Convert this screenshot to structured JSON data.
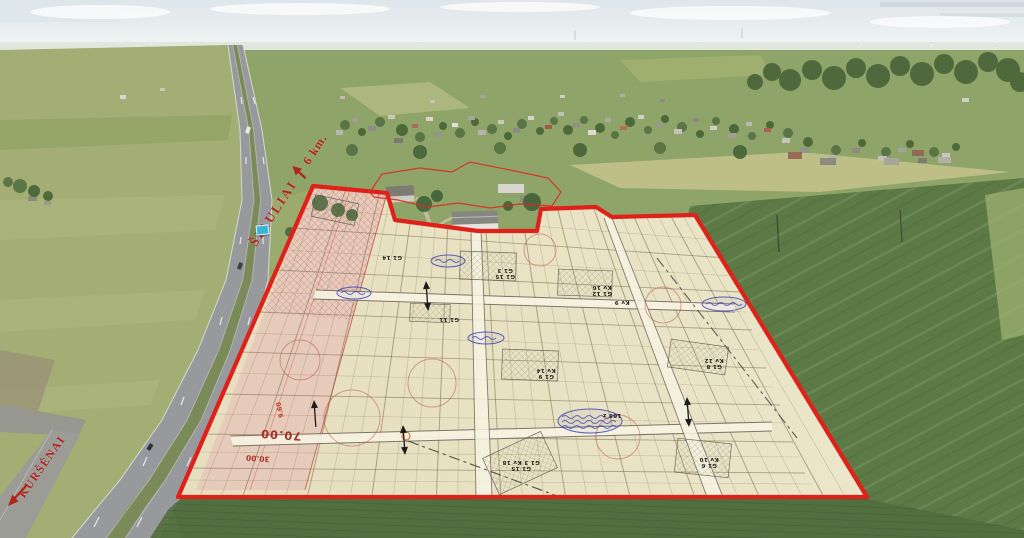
{
  "labels": {
    "siauliai": "ŠIAULIAI",
    "siauliai_distance": "6 km.",
    "kursenai": "KURŠĖNAI"
  },
  "plan": {
    "dims": {
      "d70": "70.00",
      "d30": "30.00",
      "d9": "9.60"
    },
    "plot_labels": [
      {
        "x": 505,
        "y": 272,
        "t": "G1 15\nG1 3"
      },
      {
        "x": 602,
        "y": 289,
        "t": "G1 12\nKv 16"
      },
      {
        "x": 546,
        "y": 372,
        "t": "G1 9\nKv 14"
      },
      {
        "x": 714,
        "y": 362,
        "t": "G1 8\nKv 12"
      },
      {
        "x": 521,
        "y": 464,
        "t": "G1 15\nG1 3 Kv 18"
      },
      {
        "x": 709,
        "y": 461,
        "t": "G1 6\nKv 10"
      },
      {
        "x": 449,
        "y": 318,
        "t": "G1 11"
      },
      {
        "x": 622,
        "y": 301,
        "t": "Kv 9"
      },
      {
        "x": 392,
        "y": 256,
        "t": "G1 14"
      },
      {
        "x": 612,
        "y": 414,
        "t": "105 z"
      }
    ]
  },
  "colors": {
    "boundary_red": "#e0201a",
    "label_red": "#b3241c",
    "paper_beige": "#ebe4c5",
    "stamp_blue": "#3a46b4",
    "sign_cyan": "#35b6d9"
  }
}
